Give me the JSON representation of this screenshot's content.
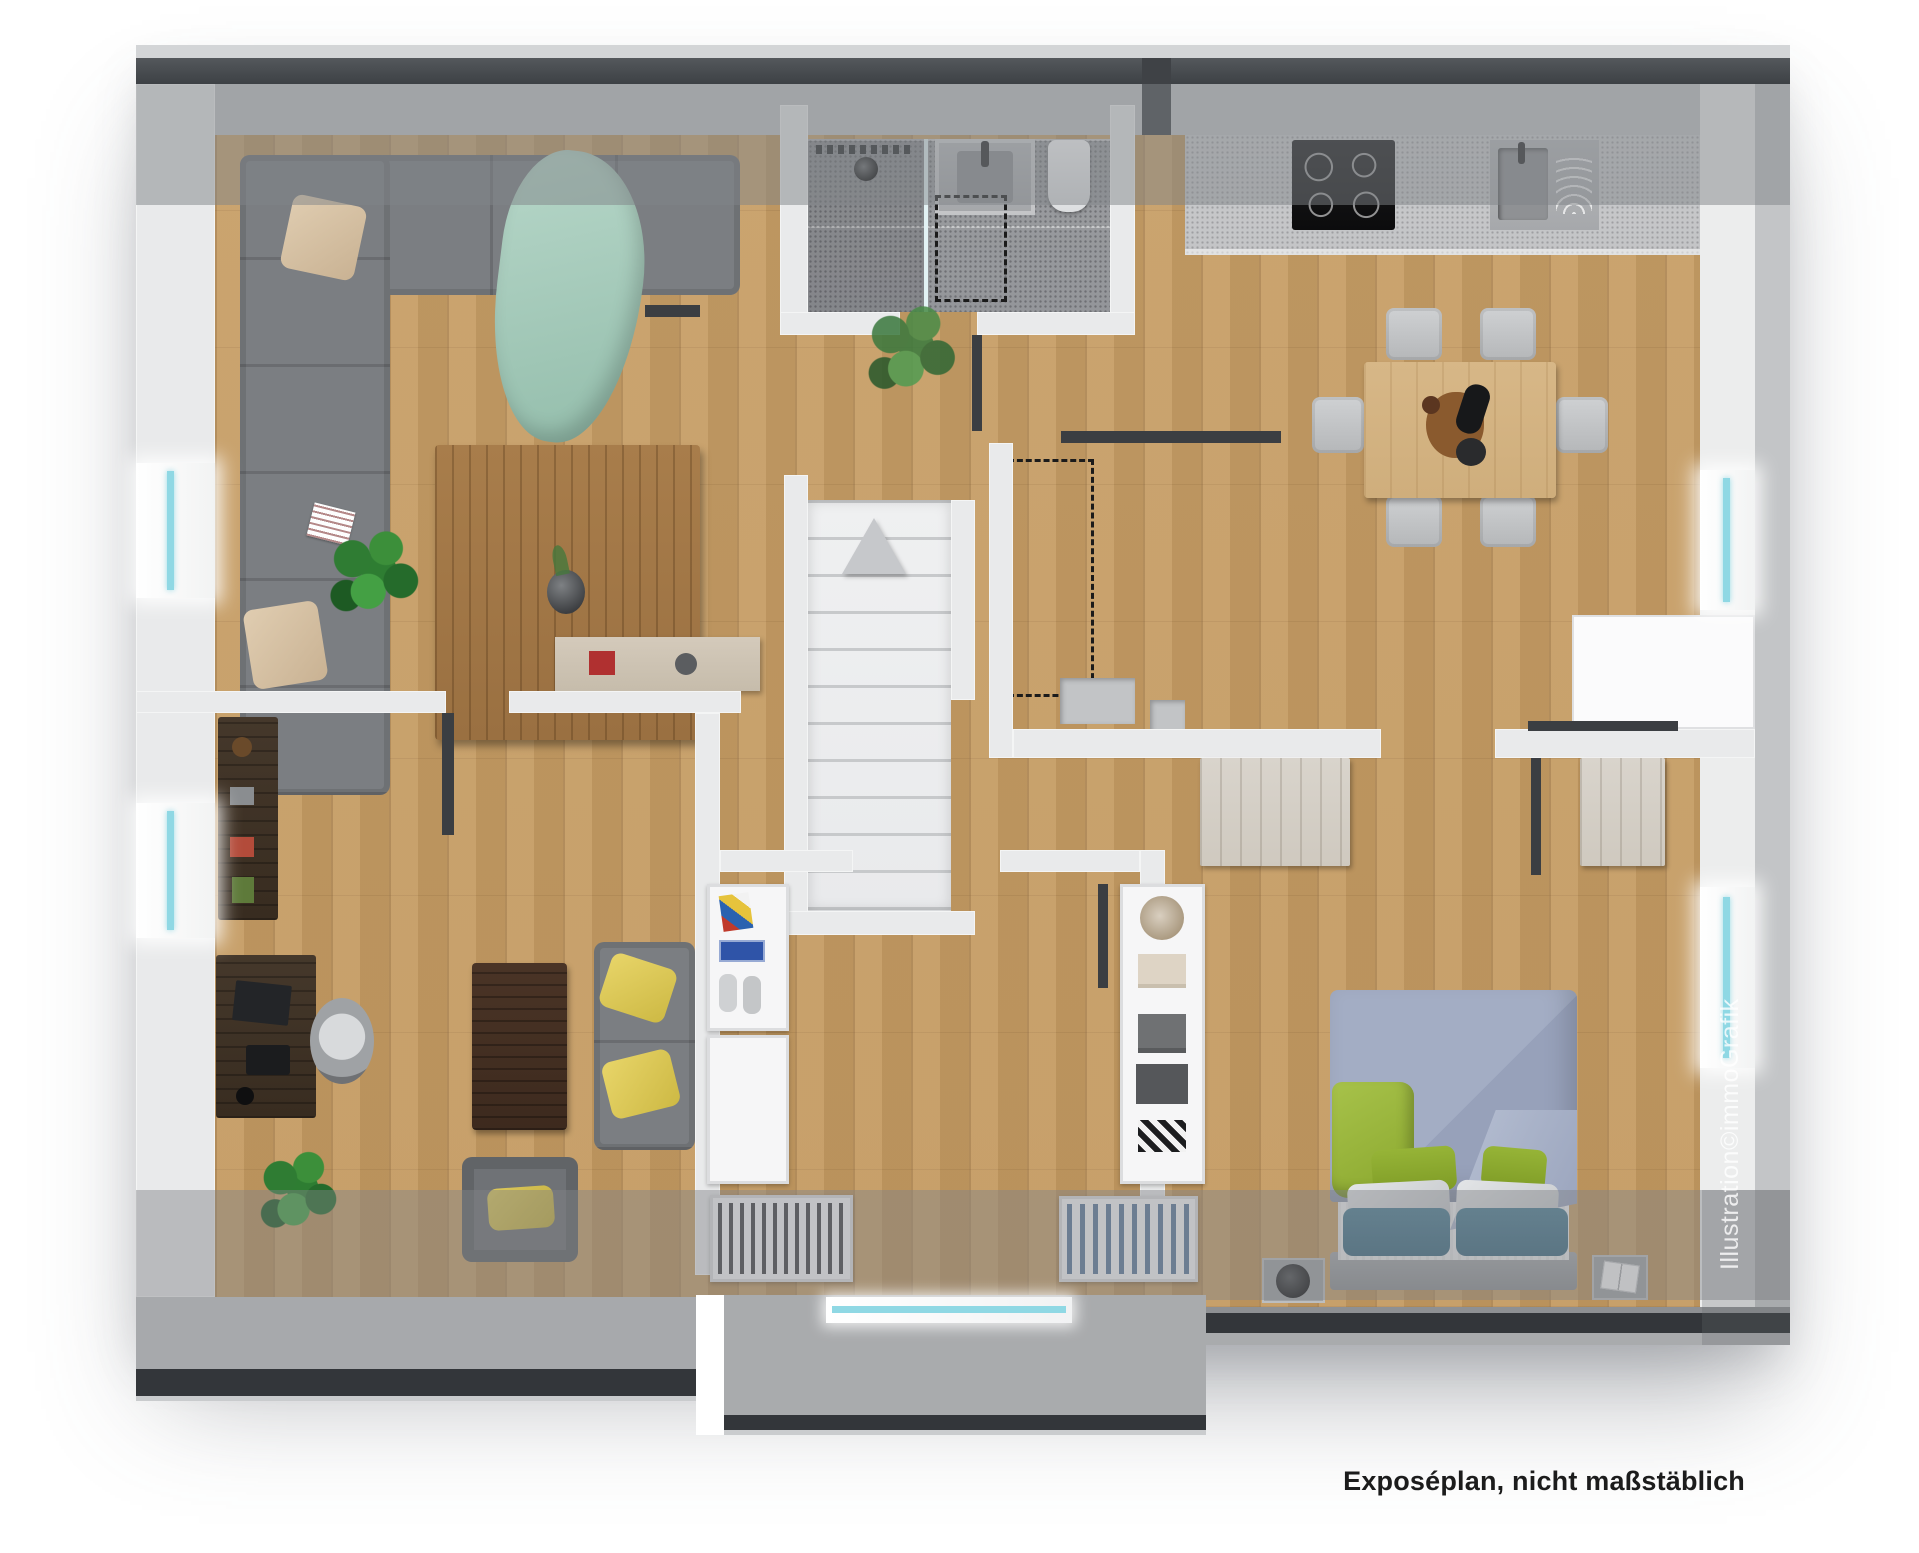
{
  "caption": "Exposéplan, nicht maßstäblich",
  "watermark": "Illustration©immoGrafik",
  "plan": {
    "view": "top-down 3D rendered floor plan of an attic apartment, roof-slope bands at top and bottom",
    "rooms": [
      {
        "name": "living-room",
        "position": "top-left",
        "furniture": [
          "L-shaped gray corner sofa",
          "two beige cushions",
          "mint green throw blanket",
          "magazine",
          "wooden coffee table with vase",
          "bushy green plant",
          "sparse grass plant",
          "light wood lowboard with decor"
        ]
      },
      {
        "name": "bathroom",
        "position": "top-center",
        "furniture": [
          "walk-in shower with line drain and glass divider",
          "round shower head",
          "washbasin with faucet",
          "toilet",
          "dashed shower enclosure marking"
        ]
      },
      {
        "name": "kitchen-dining-room",
        "position": "top-right",
        "furniture": [
          "kitchen counter",
          "black 4-zone cooktop",
          "sink with faucet",
          "square light wood dining table with food decor",
          "six gray chairs",
          "white cabinet"
        ]
      },
      {
        "name": "hallway-staircase",
        "position": "center",
        "furniture": [
          "white marble staircase",
          "direction pyramid marker",
          "dashed roof void marking",
          "gray wall niches",
          "light wood sideboard"
        ]
      },
      {
        "name": "office",
        "position": "bottom-left",
        "furniture": [
          "dark wood wall shelf with decor",
          "dark wood desk with laptop",
          "gray swivel office chair",
          "dark brown rug table",
          "gray sofa with two yellow cushions",
          "gray armchair with yellow cushion",
          "green plant"
        ]
      },
      {
        "name": "dressing-room",
        "position": "bottom-center",
        "furniture": [
          "shelf with sneakers, blue shoe box and art print",
          "rail with dark hanging clothes",
          "wardrobe with dark clothes",
          "shelf with basket and folded clothes",
          "wardrobe with blue clothes"
        ]
      },
      {
        "name": "bedroom",
        "position": "bottom-right",
        "furniture": [
          "double bed with blue-gray duvet",
          "green blanket",
          "two green pillows",
          "two white pillows",
          "two teal pillows",
          "gray headboard",
          "left nightstand with black round tray",
          "right nightstand with open magazine",
          "two light wood sideboards"
        ]
      }
    ],
    "openings": {
      "windows_left_wall": 2,
      "windows_right_wall": 2,
      "window_bottom_wall": 1,
      "dark_door_marks": 5
    },
    "colors": {
      "page_bg": "#ffffff",
      "wood_floor": "#c79e66",
      "walls": "#e9eaeb",
      "roof_edge_dark": "#45494d",
      "roof_overlay_gray": "#808387",
      "bathroom_tile": "#9b9da0",
      "stairs_marble": "#eff0f1",
      "sofa_gray": "#7b7e82",
      "cushion_beige": "#d8c3a5",
      "throw_mint": "#a9cfc0",
      "cushion_yellow": "#e0cc5a",
      "duvet_blue_gray": "#98a2bb",
      "accent_green": "#8fae2f",
      "pillow_teal": "#44758a",
      "window_glass_cyan": "#8fd8e4",
      "caption_text": "#1c1c1c",
      "watermark_text": "rgba(255,255,255,0.8)"
    }
  }
}
